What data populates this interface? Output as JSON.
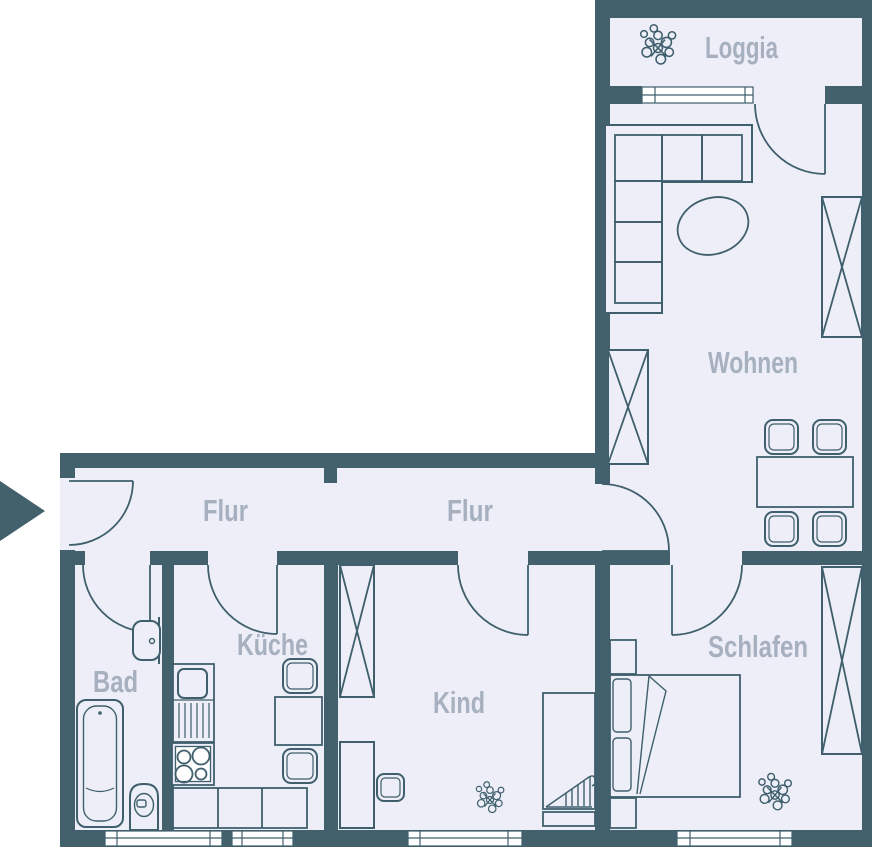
{
  "rooms": {
    "loggia": {
      "label": "Loggia"
    },
    "wohnen": {
      "label": "Wohnen"
    },
    "flur_links": {
      "label": "Flur"
    },
    "flur_rechts": {
      "label": "Flur"
    },
    "bad": {
      "label": "Bad"
    },
    "kueche": {
      "label": "Küche"
    },
    "kind": {
      "label": "Kind"
    },
    "schlafen": {
      "label": "Schlafen"
    }
  },
  "icons": {
    "plant": "plant-icon",
    "entrance": "entrance-arrow-icon"
  },
  "colors": {
    "wall": "#43606d",
    "floor": "#edeef7",
    "label": "#a6b0bf",
    "outline": "#3f5f6d",
    "window": "#ffffff",
    "background": "#ffffff"
  }
}
